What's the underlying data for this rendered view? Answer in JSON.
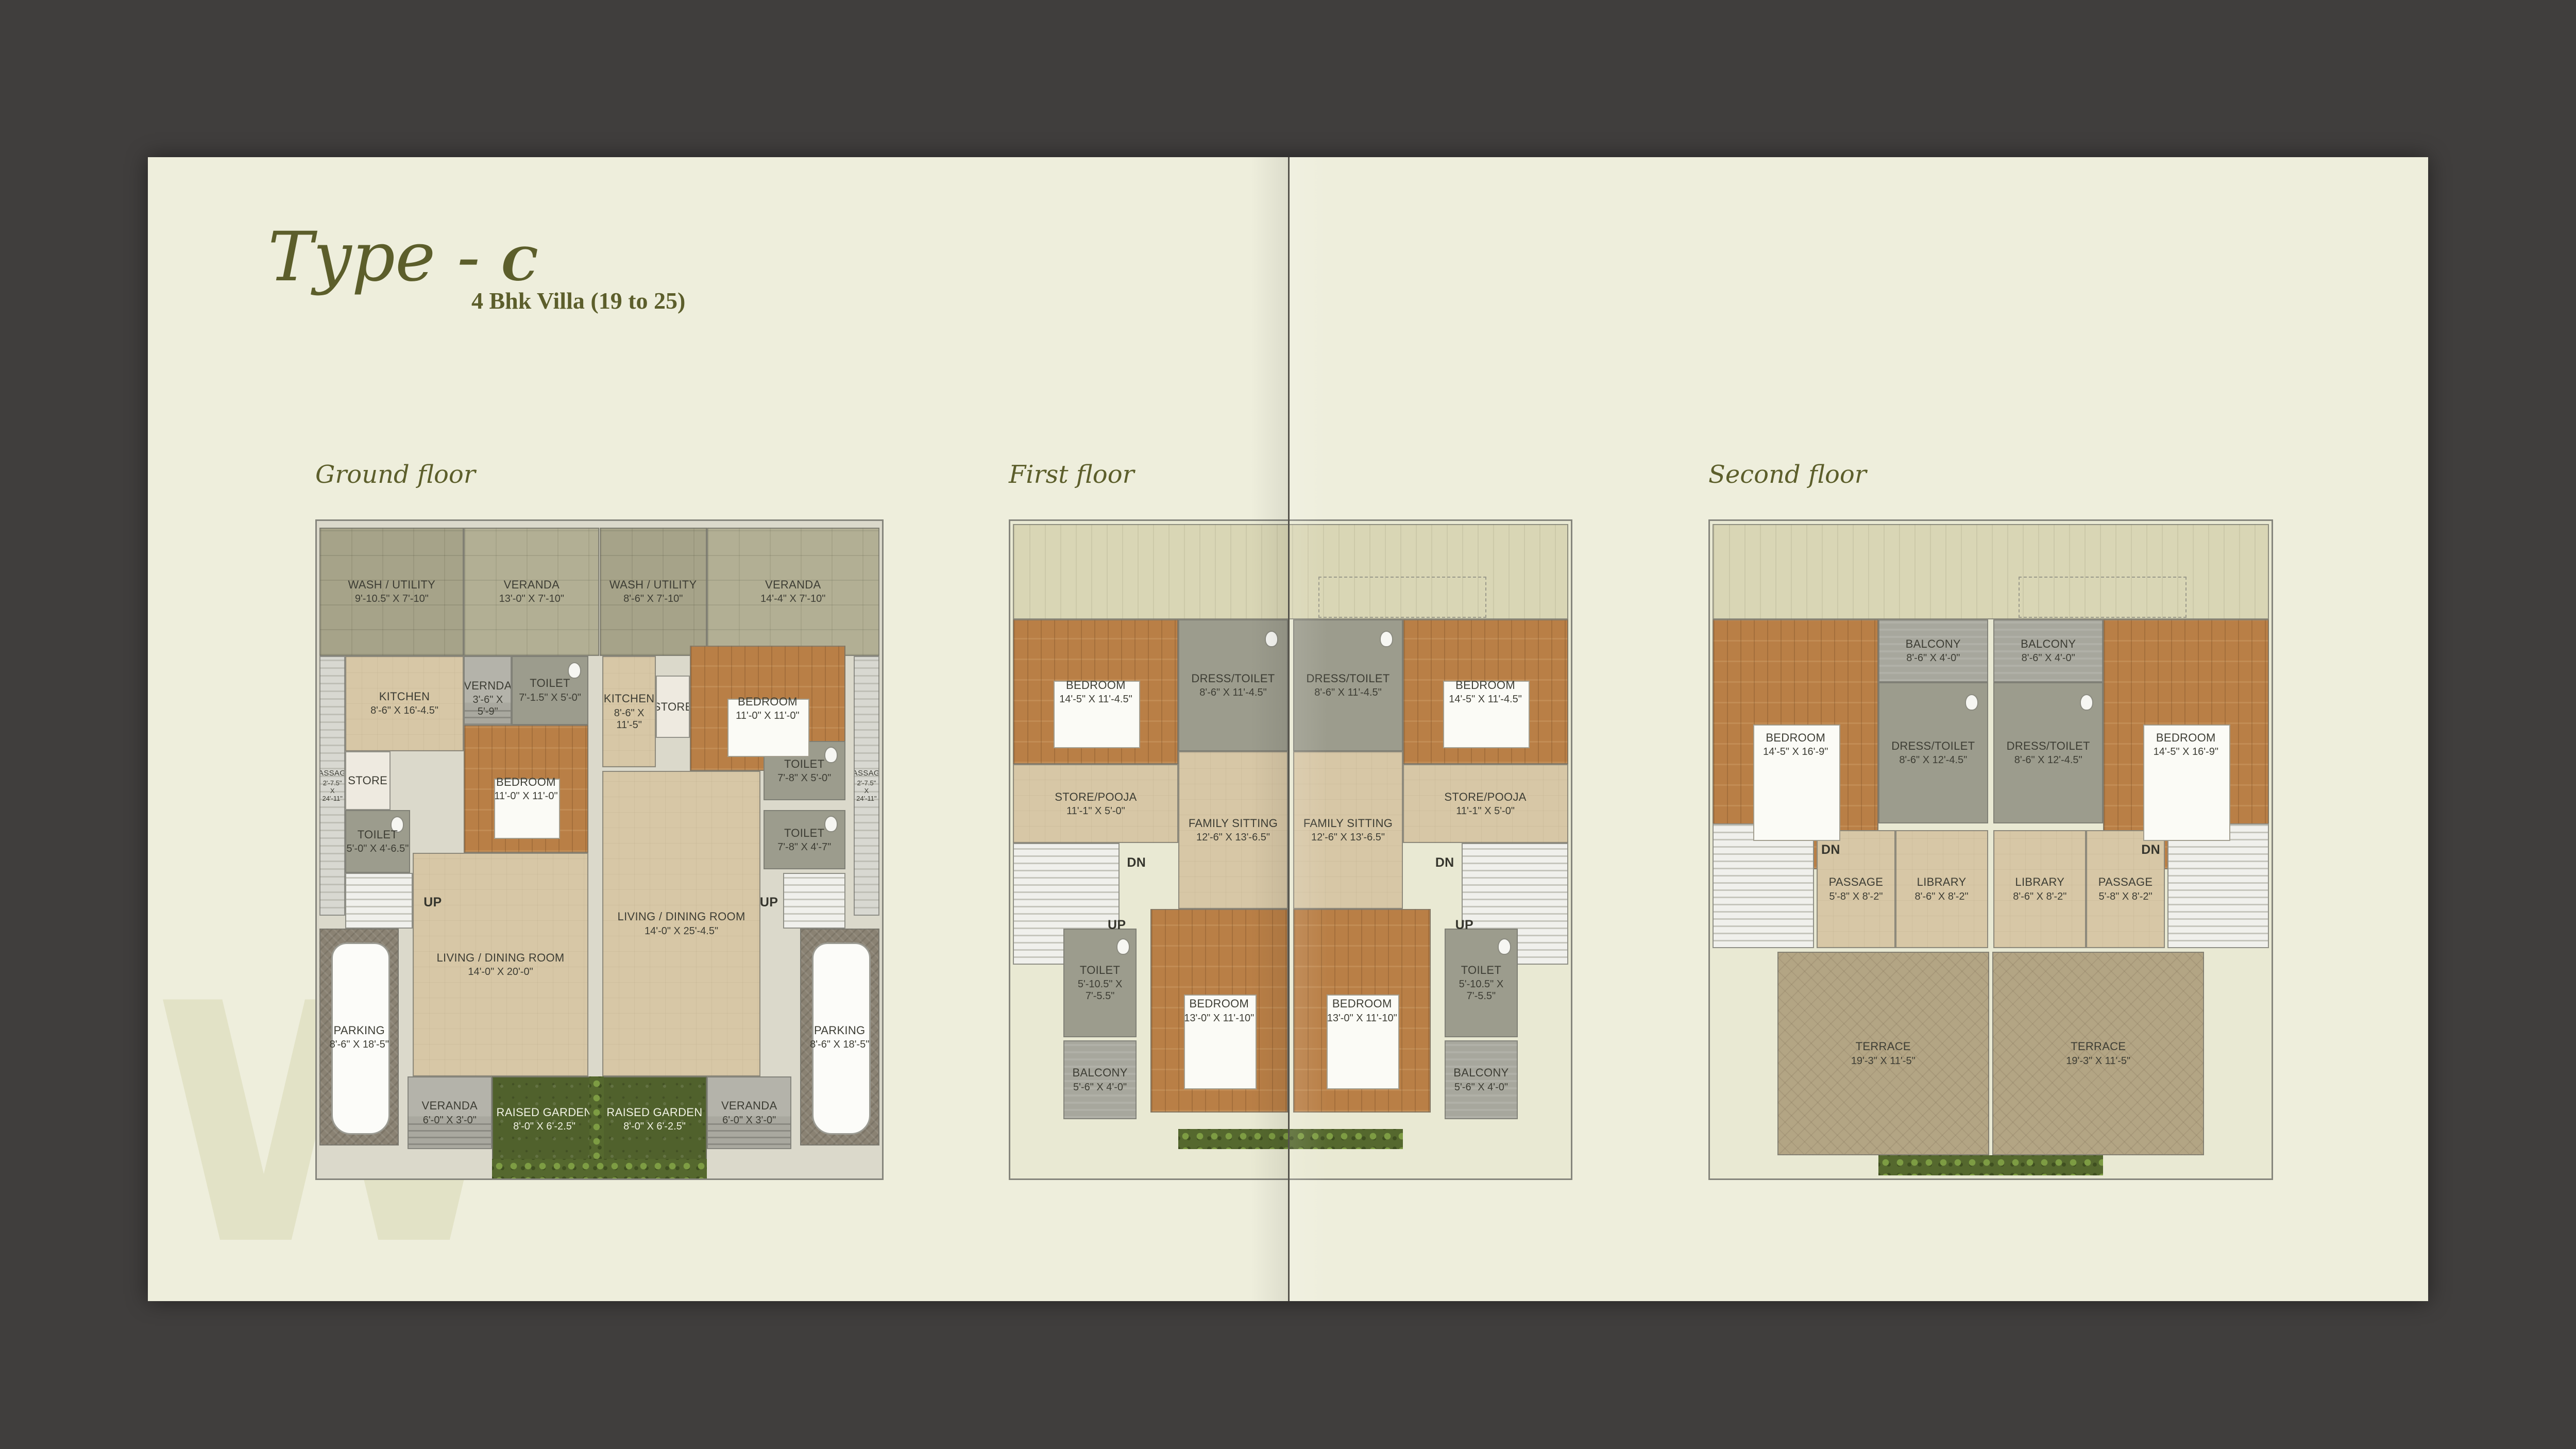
{
  "title": {
    "script": "Type - ",
    "letter": "C",
    "subtitle": "4 Bhk Villa (19 to 25)"
  },
  "watermark": {
    "letter": "W"
  },
  "colors": {
    "frame": "#403e3d",
    "page": "#eeeedc",
    "accent_olive": "#5c5e2b",
    "room_label": "#3d3d34",
    "deck_khaki": "#a6a389",
    "open_to_sky": "#d9d6b5",
    "floor_tile": "#d7c7a6",
    "wood_floor": "#b97f46",
    "bath_gray": "#9c9c8d",
    "parking_gray": "#8a8273",
    "garden_green": "#50612c",
    "terrace_tan": "#b3a584"
  },
  "floors": [
    {
      "id": "ground",
      "label": "Ground floor",
      "rooms": [
        {
          "n": "PASSAGE",
          "d": "2'-7.5\" X 24'-11\"",
          "t": "sidepass",
          "x": 0.5,
          "y": 20.5,
          "w": 4.5,
          "h": 39.5
        },
        {
          "n": "WASH / UTILITY",
          "d": "9'-10.5\" X 7'-10\"",
          "t": "deck",
          "x": 0.5,
          "y": 1,
          "w": 25.5,
          "h": 19.5
        },
        {
          "n": "VERANDA",
          "d": "13'-0\" X 7'-10\"",
          "t": "deck2",
          "x": 26,
          "y": 1,
          "w": 24,
          "h": 19.5
        },
        {
          "n": "VERNDA",
          "d": "3'-6\" X 5'-9\"",
          "t": "veranda",
          "x": 26,
          "y": 20.5,
          "w": 8.5,
          "h": 13
        },
        {
          "n": "TOILET",
          "d": "7'-1.5\" X 5'-0\"",
          "t": "bath",
          "x": 34.5,
          "y": 20.5,
          "w": 13.5,
          "h": 10.5
        },
        {
          "n": "KITCHEN",
          "d": "8'-6\" X 16'-4.5\"",
          "t": "tile",
          "x": 5,
          "y": 20.5,
          "w": 21,
          "h": 14.5
        },
        {
          "n": "STORE",
          "t": "store",
          "x": 5,
          "y": 35,
          "w": 8,
          "h": 9
        },
        {
          "n": "BEDROOM",
          "d": "11'-0\" X 11'-0\"",
          "t": "wood",
          "x": 26,
          "y": 31,
          "w": 22,
          "h": 19.5
        },
        {
          "n": "TOILET",
          "d": "5'-0\" X 4'-6.5\"",
          "t": "bath",
          "x": 5,
          "y": 44,
          "w": 11.5,
          "h": 9.5
        },
        {
          "t": "stairs",
          "x": 5,
          "y": 53.5,
          "w": 12,
          "h": 8.5
        },
        {
          "n": "UP",
          "t": "label",
          "x": 17.5,
          "y": 55.5,
          "w": 6,
          "h": 5
        },
        {
          "n": "LIVING / DINING ROOM",
          "d": "14'-0\" X 20'-0\"",
          "t": "tile",
          "x": 17,
          "y": 50.5,
          "w": 31,
          "h": 34
        },
        {
          "n": "PARKING",
          "d": "8'-6\" X 18'-5\"",
          "t": "parking",
          "x": 0.5,
          "y": 62,
          "w": 14,
          "h": 33
        },
        {
          "n": "VERANDA",
          "d": "6'-0\" X 3'-0\"",
          "t": "veranda",
          "x": 16,
          "y": 84.5,
          "w": 15,
          "h": 11
        },
        {
          "n": "RAISED GARDEN",
          "d": "8'-0\" X 6'-2.5\"",
          "t": "garden",
          "x": 31,
          "y": 84.5,
          "w": 18.5,
          "h": 13
        },
        {
          "n": "WASH / UTILITY",
          "d": "8'-6\" X 7'-10\"",
          "t": "deck",
          "x": 50,
          "y": 1,
          "w": 19,
          "h": 19.5
        },
        {
          "n": "VERANDA",
          "d": "14'-4\" X 7'-10\"",
          "t": "deck2",
          "x": 69,
          "y": 1,
          "w": 30.5,
          "h": 19.5
        },
        {
          "n": "KITCHEN",
          "d": "8'-6\" X 11'-5\"",
          "t": "tile",
          "x": 50.5,
          "y": 20.5,
          "w": 9.5,
          "h": 17
        },
        {
          "n": "STORE",
          "t": "store",
          "x": 60,
          "y": 23.5,
          "w": 6,
          "h": 9.5
        },
        {
          "n": "BEDROOM",
          "d": "11'-0\" X 11'-0\"",
          "t": "wood",
          "x": 66,
          "y": 19,
          "w": 27.5,
          "h": 19
        },
        {
          "n": "TOILET",
          "d": "7'-8\" X 5'-0\"",
          "t": "bath",
          "x": 79,
          "y": 33.5,
          "w": 14.5,
          "h": 9
        },
        {
          "n": "TOILET",
          "d": "7'-8\" X 4'-7\"",
          "t": "bath",
          "x": 79,
          "y": 44,
          "w": 14.5,
          "h": 9
        },
        {
          "n": "PASSAGE",
          "d": "2'-7.5\" X 24'-11\"",
          "t": "sidepass",
          "x": 95,
          "y": 20.5,
          "w": 4.5,
          "h": 39.5
        },
        {
          "n": "LIVING / DINING ROOM",
          "d": "14'-0\" X 25'-4.5\"",
          "t": "tile",
          "x": 50.5,
          "y": 38,
          "w": 28,
          "h": 46.5
        },
        {
          "t": "stairs",
          "x": 82.5,
          "y": 53.5,
          "w": 11,
          "h": 8.5
        },
        {
          "n": "UP",
          "t": "label",
          "x": 77.5,
          "y": 55.5,
          "w": 5,
          "h": 5
        },
        {
          "n": "PARKING",
          "d": "8'-6\" X 18'-5\"",
          "t": "parking",
          "x": 85.5,
          "y": 62,
          "w": 14,
          "h": 33
        },
        {
          "n": "RAISED GARDEN",
          "d": "8'-0\" X 6'-2.5\"",
          "t": "garden",
          "x": 50.5,
          "y": 84.5,
          "w": 18.5,
          "h": 13
        },
        {
          "n": "VERANDA",
          "d": "6'-0\" X 3'-0\"",
          "t": "veranda",
          "x": 69,
          "y": 84.5,
          "w": 15,
          "h": 11
        },
        {
          "t": "plants",
          "x": 48.2,
          "y": 84.5,
          "w": 2.6,
          "h": 15
        },
        {
          "t": "plants",
          "x": 31,
          "y": 97,
          "w": 38,
          "h": 3
        }
      ]
    },
    {
      "id": "first",
      "label": "First floor",
      "rooms": [
        {
          "t": "open",
          "x": 0.5,
          "y": 0.5,
          "w": 99,
          "h": 14.5
        },
        {
          "n": "BEDROOM",
          "d": "14'-5\" X 11'-4.5\"",
          "t": "wood",
          "x": 0.5,
          "y": 15,
          "w": 29.5,
          "h": 22
        },
        {
          "n": "DRESS/TOILET",
          "d": "8'-6\" X 11'-4.5\"",
          "t": "bath",
          "x": 30,
          "y": 15,
          "w": 19.5,
          "h": 20
        },
        {
          "n": "DRESS/TOILET",
          "d": "8'-6\" X 11'-4.5\"",
          "t": "bath",
          "x": 50.5,
          "y": 15,
          "w": 19.5,
          "h": 20
        },
        {
          "n": "BEDROOM",
          "d": "14'-5\" X 11'-4.5\"",
          "t": "wood",
          "x": 70,
          "y": 15,
          "w": 29.5,
          "h": 22
        },
        {
          "n": "STORE/POOJA",
          "d": "11'-1\" X 5'-0\"",
          "t": "tile",
          "x": 0.5,
          "y": 37,
          "w": 29.5,
          "h": 12
        },
        {
          "n": "STORE/POOJA",
          "d": "11'-1\" X 5'-0\"",
          "t": "tile",
          "x": 70,
          "y": 37,
          "w": 29.5,
          "h": 12
        },
        {
          "n": "FAMILY SITTING",
          "d": "12'-6\" X 13'-6.5\"",
          "t": "tile",
          "x": 30,
          "y": 35,
          "w": 19.5,
          "h": 24
        },
        {
          "n": "FAMILY SITTING",
          "d": "12'-6\" X 13'-6.5\"",
          "t": "tile",
          "x": 50.5,
          "y": 35,
          "w": 19.5,
          "h": 24
        },
        {
          "t": "stairs",
          "x": 0.5,
          "y": 49,
          "w": 19,
          "h": 18.5
        },
        {
          "t": "stairs",
          "x": 80.5,
          "y": 49,
          "w": 19,
          "h": 18.5
        },
        {
          "n": "DN",
          "t": "label",
          "x": 20,
          "y": 49.5,
          "w": 5,
          "h": 5
        },
        {
          "n": "DN",
          "t": "label",
          "x": 75,
          "y": 49.5,
          "w": 5,
          "h": 5
        },
        {
          "n": "UP",
          "t": "label",
          "x": 16.5,
          "y": 59,
          "w": 5,
          "h": 5
        },
        {
          "n": "UP",
          "t": "label",
          "x": 78.5,
          "y": 59,
          "w": 5,
          "h": 5
        },
        {
          "n": "BEDROOM",
          "d": "13'-0\" X 11'-10\"",
          "t": "wood",
          "x": 25,
          "y": 59,
          "w": 24.5,
          "h": 31
        },
        {
          "n": "BEDROOM",
          "d": "13'-0\" X 11'-10\"",
          "t": "wood",
          "x": 50.5,
          "y": 59,
          "w": 24.5,
          "h": 31
        },
        {
          "n": "TOILET",
          "d": "5'-10.5\" X 7'-5.5\"",
          "t": "bath",
          "x": 9.5,
          "y": 62,
          "w": 13,
          "h": 16.5
        },
        {
          "n": "TOILET",
          "d": "5'-10.5\" X 7'-5.5\"",
          "t": "bath",
          "x": 77.5,
          "y": 62,
          "w": 13,
          "h": 16.5
        },
        {
          "n": "BALCONY",
          "d": "5'-6\" X 4'-0\"",
          "t": "balcony",
          "x": 9.5,
          "y": 79,
          "w": 13,
          "h": 12
        },
        {
          "n": "BALCONY",
          "d": "5'-6\" X 4'-0\"",
          "t": "balcony",
          "x": 77.5,
          "y": 79,
          "w": 13,
          "h": 12
        },
        {
          "t": "plants",
          "x": 30,
          "y": 92.5,
          "w": 40,
          "h": 3
        }
      ]
    },
    {
      "id": "second",
      "label": "Second floor",
      "rooms": [
        {
          "t": "open",
          "x": 0.5,
          "y": 0.5,
          "w": 99,
          "h": 14.5
        },
        {
          "n": "BEDROOM",
          "d": "14'-5\" X 16'-9\"",
          "t": "wood",
          "x": 0.5,
          "y": 15,
          "w": 29.5,
          "h": 38
        },
        {
          "n": "BEDROOM",
          "d": "14'-5\" X 16'-9\"",
          "t": "wood",
          "x": 70,
          "y": 15,
          "w": 29.5,
          "h": 38
        },
        {
          "n": "BALCONY",
          "d": "8'-6\" X 4'-0\"",
          "t": "balcony",
          "x": 30,
          "y": 15,
          "w": 19.5,
          "h": 9.5
        },
        {
          "n": "BALCONY",
          "d": "8'-6\" X 4'-0\"",
          "t": "balcony",
          "x": 50.5,
          "y": 15,
          "w": 19.5,
          "h": 9.5
        },
        {
          "n": "DRESS/TOILET",
          "d": "8'-6\" X 12'-4.5\"",
          "t": "bath",
          "x": 30,
          "y": 24.5,
          "w": 19.5,
          "h": 21.5
        },
        {
          "n": "DRESS/TOILET",
          "d": "8'-6\" X 12'-4.5\"",
          "t": "bath",
          "x": 50.5,
          "y": 24.5,
          "w": 19.5,
          "h": 21.5
        },
        {
          "t": "stairs",
          "x": 0.5,
          "y": 46,
          "w": 18,
          "h": 19
        },
        {
          "t": "stairs",
          "x": 81.5,
          "y": 46,
          "w": 18,
          "h": 19
        },
        {
          "n": "DN",
          "t": "label",
          "x": 19,
          "y": 47.5,
          "w": 5,
          "h": 5
        },
        {
          "n": "DN",
          "t": "label",
          "x": 76,
          "y": 47.5,
          "w": 5,
          "h": 5
        },
        {
          "n": "PASSAGE",
          "d": "5'-8\" X 8'-2\"",
          "t": "tile",
          "x": 19,
          "y": 47,
          "w": 14,
          "h": 18
        },
        {
          "n": "PASSAGE",
          "d": "5'-8\" X 8'-2\"",
          "t": "tile",
          "x": 67,
          "y": 47,
          "w": 14,
          "h": 18
        },
        {
          "n": "LIBRARY",
          "d": "8'-6\" X 8'-2\"",
          "t": "tile",
          "x": 33,
          "y": 47,
          "w": 16.5,
          "h": 18
        },
        {
          "n": "LIBRARY",
          "d": "8'-6\" X 8'-2\"",
          "t": "tile",
          "x": 50.5,
          "y": 47,
          "w": 16.5,
          "h": 18
        },
        {
          "n": "TERRACE",
          "d": "19'-3\" X 11'-5\"",
          "t": "terrace",
          "x": 12,
          "y": 65.5,
          "w": 37.7,
          "h": 31
        },
        {
          "n": "TERRACE",
          "d": "19'-3\" X 11'-5\"",
          "t": "terrace",
          "x": 50.3,
          "y": 65.5,
          "w": 37.7,
          "h": 31
        },
        {
          "t": "plants",
          "x": 30,
          "y": 96.5,
          "w": 40,
          "h": 3
        }
      ]
    }
  ]
}
